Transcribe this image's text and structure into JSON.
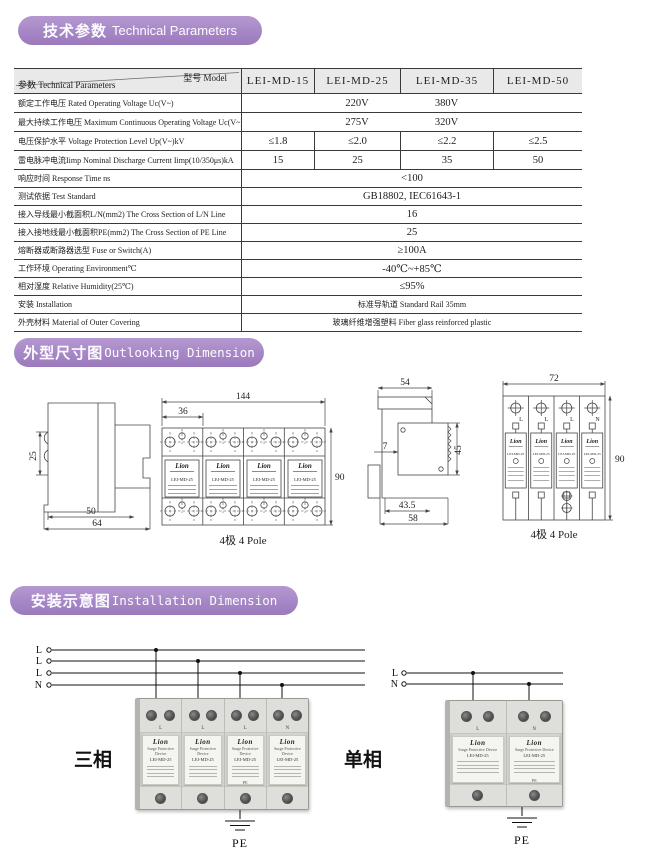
{
  "sections": {
    "technical": {
      "title_zh": "技术参数",
      "title_en": "Technical Parameters"
    },
    "outline": {
      "title_zh": "外型尺寸图",
      "title_en": "Outlooking Dimension"
    },
    "installation": {
      "title_zh": "安装示意图",
      "title_en": "Installation Dimension"
    }
  },
  "table": {
    "corner_top": "型号 Model",
    "corner_bottom": "参数 Technical Parameters",
    "models": [
      "LEI-MD-15",
      "LEI-MD-25",
      "LEI-MD-35",
      "LEI-MD-50"
    ],
    "rows": [
      {
        "label": "额定工作电压 Rated Operating Voltage Uc(V~)",
        "values": [
          "",
          "220V",
          "380V",
          ""
        ]
      },
      {
        "label": "最大持续工作电压 Maximum Continuous Operating Voltage Uc(V~)",
        "values": [
          "",
          "275V",
          "320V",
          ""
        ]
      },
      {
        "label": "电压保护水平 Voltage Protection Level Up(V~)kV",
        "values": [
          "≤1.8",
          "≤2.0",
          "≤2.2",
          "≤2.5"
        ]
      },
      {
        "label": "雷电脉冲电流Iimp Nominal Discharge Current Iimp(10/350μs)kA",
        "values": [
          "15",
          "25",
          "35",
          "50"
        ]
      },
      {
        "label": "响应时间 Response Time ns",
        "value": "<100"
      },
      {
        "label": "测试依据 Test Standard",
        "value": "GB18802, IEC61643-1"
      },
      {
        "label": "接入导线最小截面积L/N(mm2) The Cross Section of L/N Line",
        "value": "16"
      },
      {
        "label": "接入接地线最小截面积PE(mm2) The Cross Section of PE Line",
        "value": "25"
      },
      {
        "label": "熔断器或断路器选型 Fuse or Switch(A)",
        "value": "≥100A"
      },
      {
        "label": "工作环境 Operating Environment℃",
        "value": "-40℃~+85℃"
      },
      {
        "label": "相对湿度 Relative Humidity(25℃)",
        "value": "≤95%"
      },
      {
        "label": "安装 Installation",
        "value": "标准导轨道 Standard Rail 35mm"
      },
      {
        "label": "外壳材料 Material of Outer Covering",
        "value": "玻璃纤维增强塑料 Fiber glass reinforced plastic"
      }
    ]
  },
  "outline_drawings": {
    "pole_caption": "4极 4 Pole",
    "side_view_1": {
      "height": "25",
      "width_inner": "50",
      "width_outer": "64"
    },
    "front_view": {
      "total_width": "144",
      "module_width": "36",
      "height": "90",
      "brand": "Lion",
      "model": "LEI-MD-25"
    },
    "side_view_2": {
      "top_width": "54",
      "clip_depth": "7",
      "body_height": "45",
      "width_inner": "43.5",
      "width_outer": "58"
    },
    "schematic": {
      "width": "72",
      "height": "90",
      "terminals": [
        "L",
        "L",
        "L",
        "N"
      ],
      "brand": "Lion",
      "model": "LEI-MD-25"
    }
  },
  "installation": {
    "three_phase": {
      "label": "三相",
      "wires": [
        "L",
        "L",
        "L",
        "N"
      ]
    },
    "single_phase": {
      "label": "单相",
      "wires": [
        "L",
        "N"
      ]
    },
    "pe_label": "PE",
    "device": {
      "brand": "Lion",
      "subtitle": "Surge Protective Device",
      "model": "LEI-MD-25"
    }
  }
}
